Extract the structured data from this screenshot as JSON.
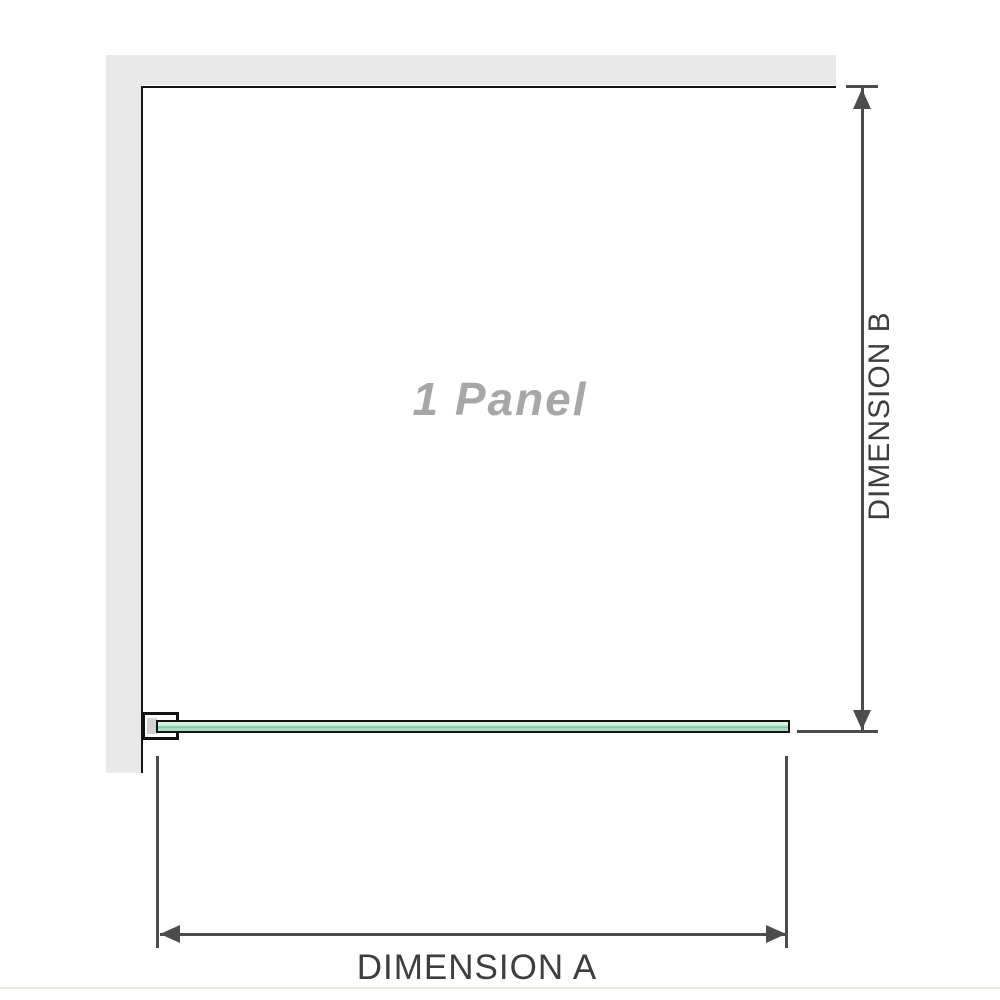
{
  "diagram": {
    "title": "1 Panel",
    "labels": {
      "dimension_a": "DIMENSION A",
      "dimension_b": "DIMENSION B"
    },
    "colors": {
      "wall": "#e9e9e9",
      "panel_border": "#141414",
      "line": "#4c4c4c",
      "label_text": "#3e3e3e",
      "title_text": "#a7a7a7",
      "glass_light": "#d9f2e4",
      "glass_mid": "#aedec2",
      "glass_dark": "#7cc59a",
      "bracket_shade": "#d2d2d2",
      "separator": "#eae7df"
    }
  }
}
